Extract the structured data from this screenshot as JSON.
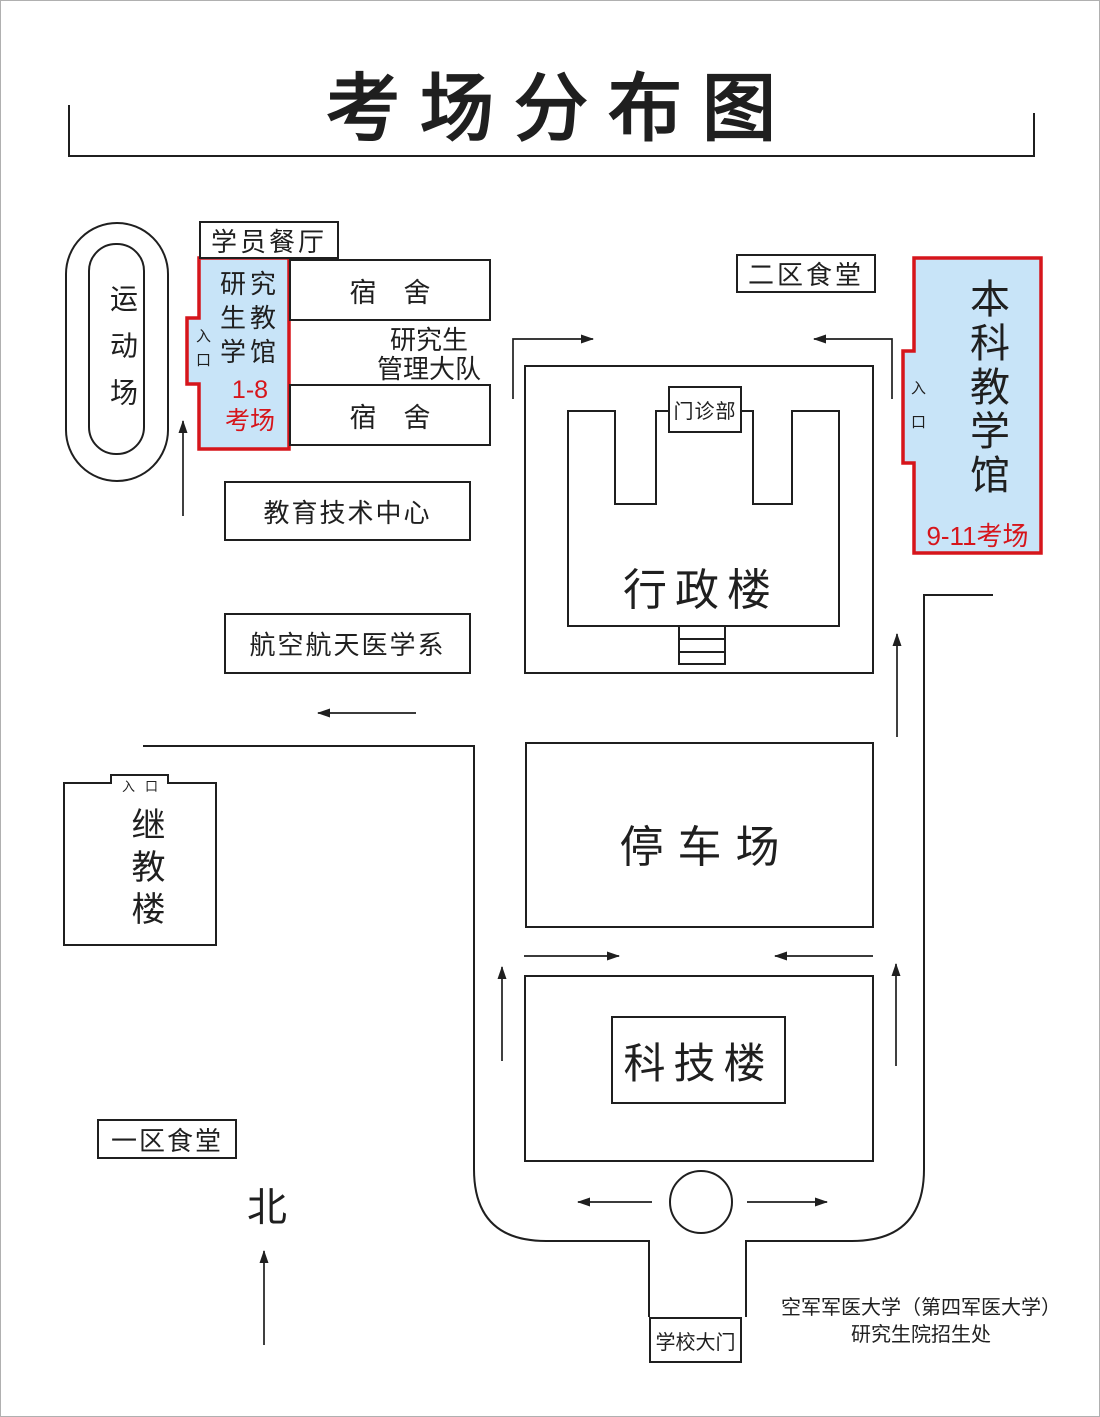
{
  "page": {
    "title": "考场分布图"
  },
  "colors": {
    "line": "#1f1f1f",
    "exam_fill": "#c8e4f8",
    "exam_border": "#d6151b",
    "exam_text": "#d6151b"
  },
  "labels": {
    "sports_field": "运动场",
    "student_canteen": "学员餐厅",
    "grad_hall_name": "研究生教学馆",
    "grad_hall_rooms_line1": "1-8",
    "grad_hall_rooms_line2": "考场",
    "grad_hall_entrance": "入口",
    "dorm_top": "宿　舍",
    "dorm_bottom": "宿　舍",
    "grad_mgmt_line1": "研究生",
    "grad_mgmt_line2": "管理大队",
    "canteen_district2": "二区食堂",
    "undergrad_hall_name": "本科教学馆",
    "undergrad_hall_rooms": "9-11考场",
    "undergrad_hall_entrance": "入口",
    "edu_tech_center": "教育技术中心",
    "clinic": "门诊部",
    "admin_building": "行政楼",
    "aerospace_medicine": "航空航天医学系",
    "continuing_edu_building": "继教楼",
    "continuing_edu_entrance": "入口",
    "parking_lot": "停车场",
    "scitech_building": "科技楼",
    "canteen_district1": "一区食堂",
    "school_gate": "学校大门",
    "north": "北"
  },
  "footer": {
    "line1": "空军军医大学（第四军医大学）",
    "line2": "研究生院招生处"
  }
}
